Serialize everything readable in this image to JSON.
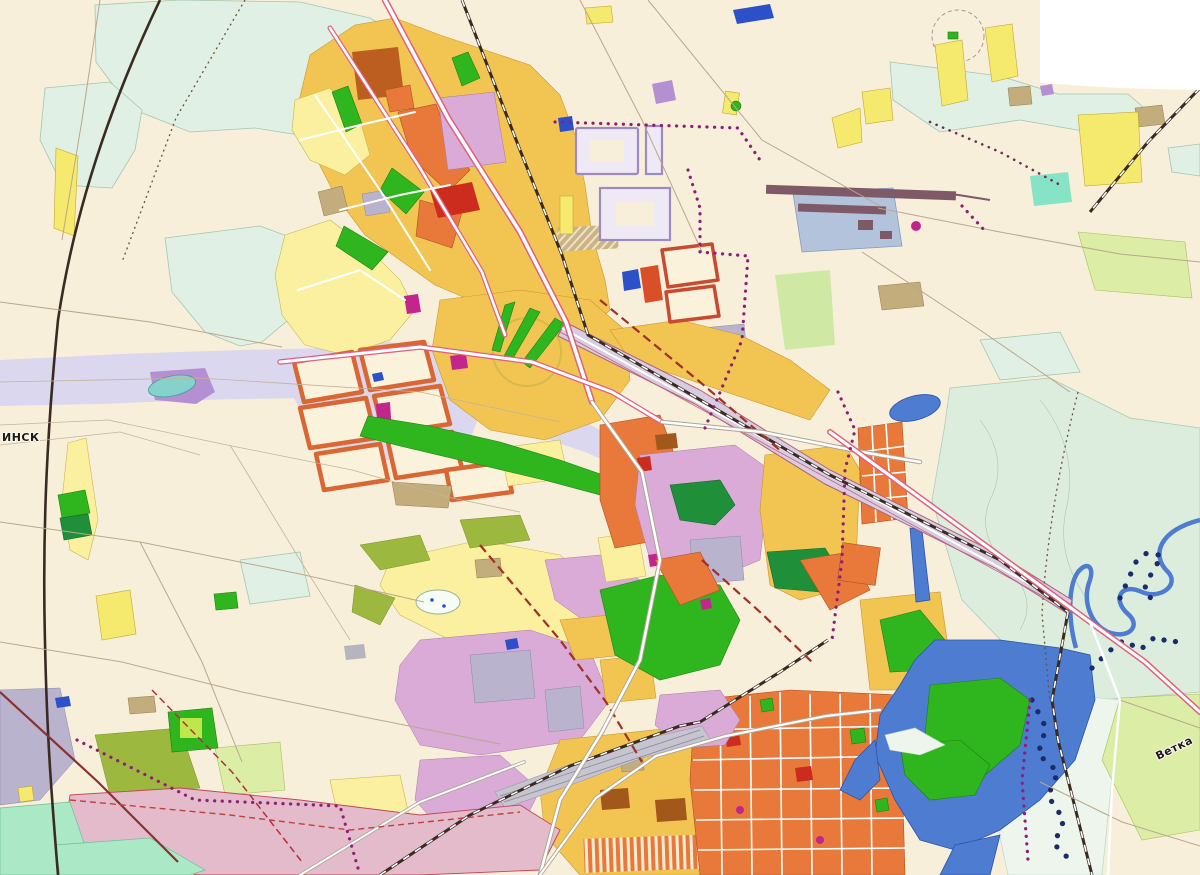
{
  "map": {
    "labels": [
      {
        "id": "minsk-direction",
        "text": "ИНСК"
      },
      {
        "id": "vetka-direction",
        "text": "Ветка"
      }
    ],
    "palette": {
      "background": "#F8EFDA",
      "map_edge_white": "#FFFFFF",
      "forest_mint": "#E1F0E5",
      "meadow_mint": "#DCEDDD",
      "floodplain_pale": "#EDF5EC",
      "seafoam": "#ABE8C6",
      "teal_mint": "#86E3C6",
      "field_lime": "#DCEDA6",
      "field_light_green": "#CFE9A4",
      "pale_yellow": "#FAF0A0",
      "yellow": "#F5E96E",
      "amber": "#F2C553",
      "orange": "#E8793A",
      "red_orange": "#D94F28",
      "red": "#CC2C1E",
      "brown_orange": "#BC5E1F",
      "dark_brown": "#A2571B",
      "park_green": "#2FB51E",
      "dark_green": "#1F8F3A",
      "lime_green": "#BFE64A",
      "olive_green": "#9CB83E",
      "lilac": "#D9ABD6",
      "grey_lilac": "#B9B3CE",
      "pale_lilac": "#EFE9F5",
      "planned_outline": "#9D8BC0",
      "lavender_band": "#DBD7EE",
      "purple": "#B48FD2",
      "pink_mauve": "#E3BBCB",
      "magenta": "#C2268C",
      "water_blue": "#4D7CD0",
      "navy_dot": "#1B2B6B",
      "teal_pond": "#85D2CC",
      "khaki": "#C3AD7C",
      "grey_block": "#B5B5BD",
      "rail_corridor_grey": "#C6C4CF",
      "runway_plum": "#7E5A68",
      "apron_blue": "#B3C3DC",
      "bright_blue": "#2B50C8",
      "corridor_fill": "#D8CCE0",
      "road_pink": "#E0607E",
      "road_white": "#FFFFFF",
      "boundary_purple": "#8E1F78",
      "rail_dark": "#3A2B20",
      "label_dark": "#1A1A1A"
    }
  }
}
